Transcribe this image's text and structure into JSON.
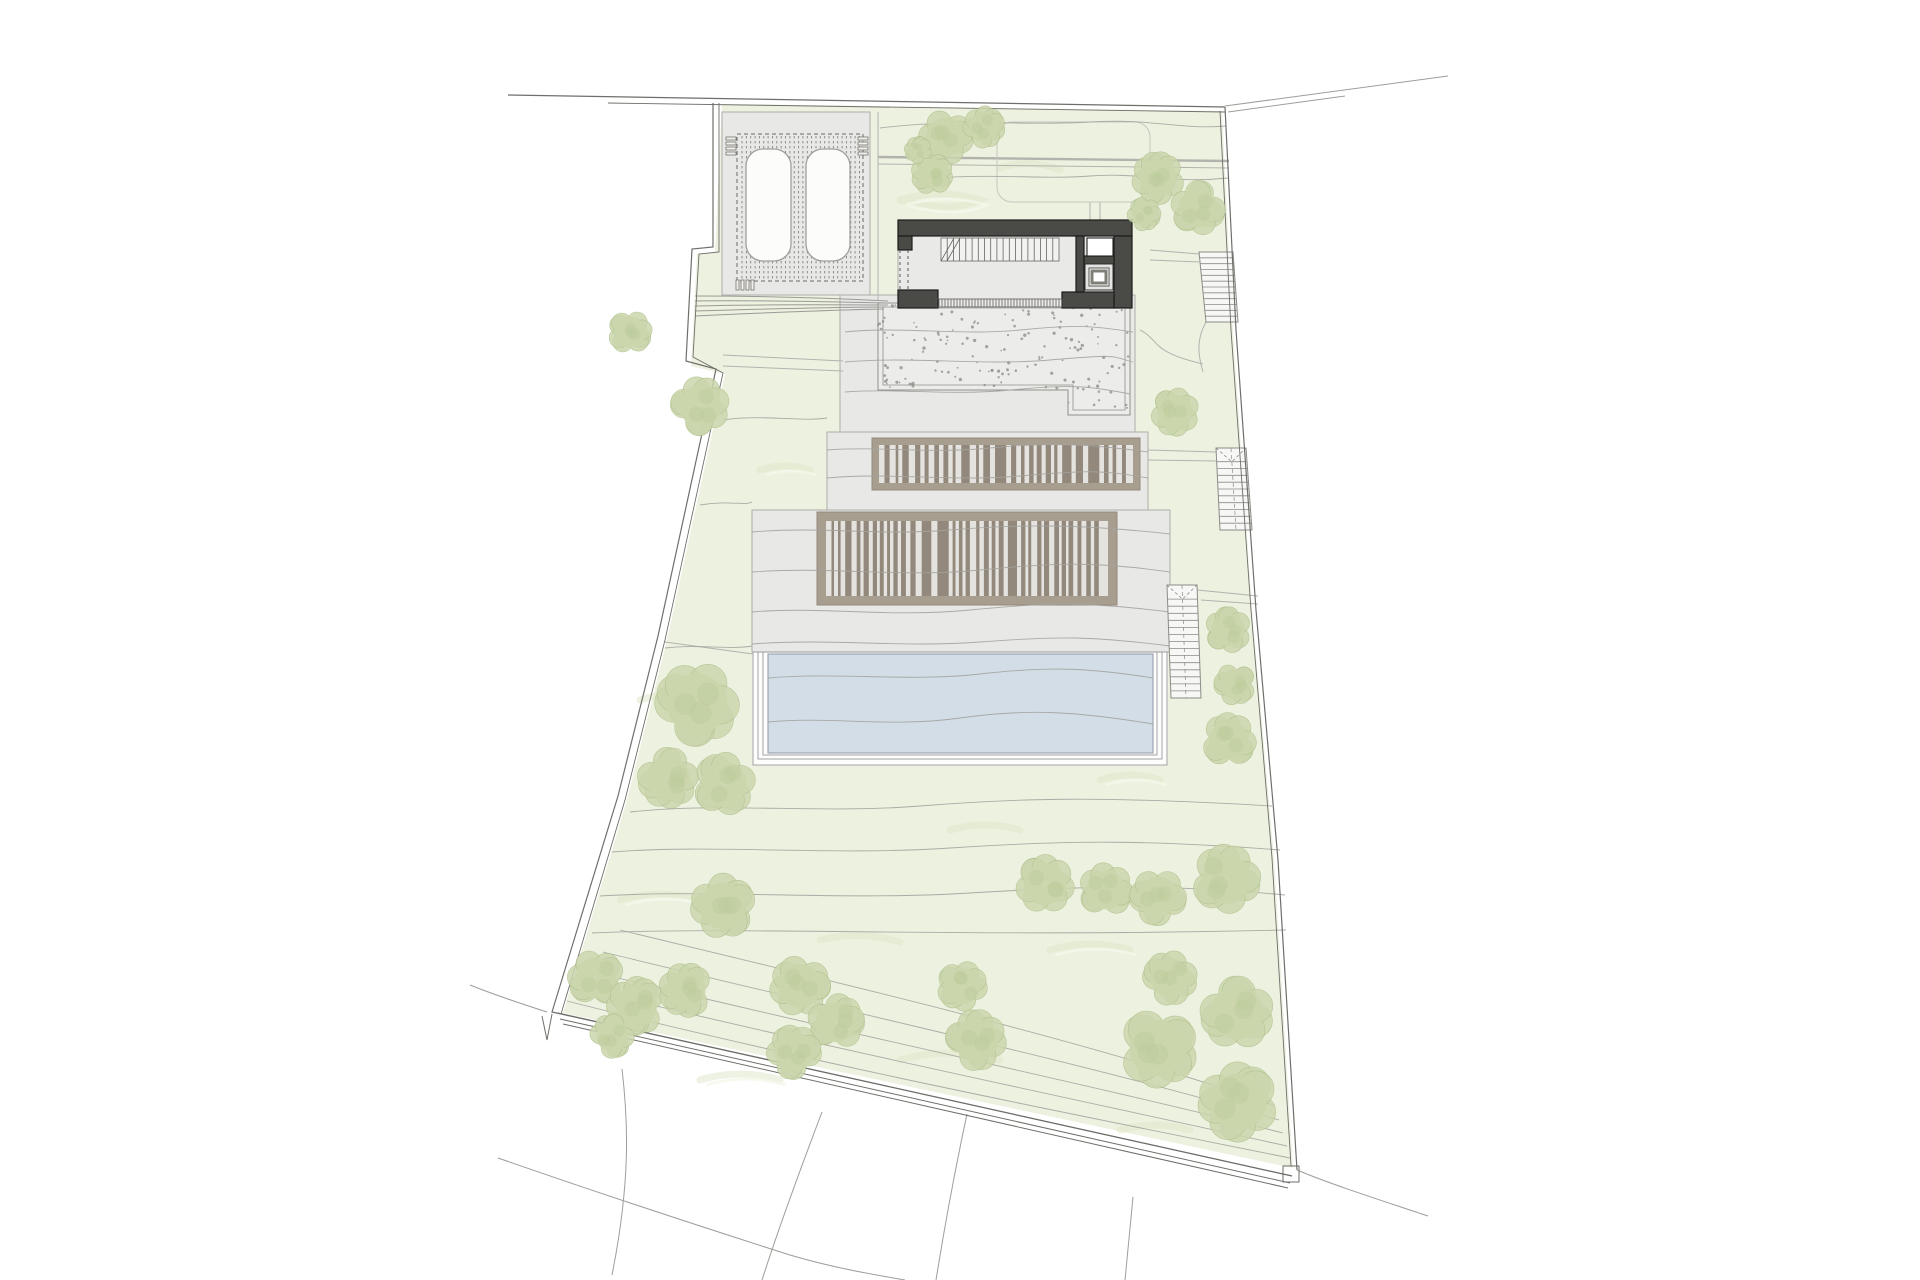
{
  "canvas": {
    "w": 1920,
    "h": 1280,
    "bg": "#ffffff"
  },
  "palette": {
    "green": "#edf1e0",
    "green_texture": "#e0e8cb",
    "green_texture_light": "#f4f7ea",
    "platform_fill": "#e8e8e6",
    "platform_stroke": "#adadaa",
    "stipple_fill": "#ececea",
    "stipple_dot": "#8a8a85",
    "stipple_stroke": "#8f8f8b",
    "frame_fill": "#a89e90",
    "frame_stroke": "#938a7c",
    "deck_inner": "#e5e3df",
    "slat": "#8d8375",
    "wall_dark": "#4a4a47",
    "wall_dark_stroke": "#1c1c1a",
    "floor": "#e9e9e7",
    "pool_water": "#d2dde7",
    "pool_stroke": "#97a1ab",
    "contour": "#a3a39e",
    "boundary": "#6e6e6a",
    "outside_line": "#9d9d99",
    "path_line": "#b3b3ae",
    "stair_fill": "#f7f7f5",
    "stair_stroke": "#8b8b87",
    "tree_fill": "#cbd6ad",
    "tree_inner": "#bccb9b",
    "tree_stroke": "#aebf8a",
    "car_fill": "#fcfcfb",
    "car_stroke": "#a0a09a",
    "dash_line": "#6a6a66",
    "tick": "#55534f"
  },
  "plot": {
    "green_points": "722,104 1222,111 1233,330 1252,610 1274,858 1293,1168 563,1013 627,800 667,640 725,374 691,366 697,254 715,252",
    "boundary_outer": "M713,103 L713,247 L692,249 L686,361 L716,369 L658,636 L618,796 L552,1012 L1292,1176",
    "boundary_inner_left": "M719,103 L719,252 L699,254 L693,357 L723,373 L665,640 L625,800 L561,1014",
    "boundary_top_outer": "M508,95 L1225,107",
    "boundary_top_inner": "M608,103 L1225,112",
    "boundary_right_outer": "M1225,107 L1236,330 L1256,610 L1278,860 L1297,1170",
    "boundary_right_inner": "M1220,111 L1231,330 L1251,610 L1272,858 L1291,1166",
    "boundary_bottom_lines": [
      "M558,1013 L1292,1176",
      "M560,1019 L1290,1183",
      "M563,1024 L1288,1188"
    ],
    "notch_v": "M542,1016 L547,1040 L552,1014",
    "corner_notch": {
      "x": 1283,
      "y": 1166,
      "w": 16,
      "h": 16
    }
  },
  "outside_lines": [
    {
      "d": "M1225,106 L1448,76"
    },
    {
      "d": "M1228,112 L1345,96"
    },
    {
      "d": "M622,1069 C628,1120 631,1180 612,1275"
    },
    {
      "d": "M822,1112 C800,1170 778,1230 762,1280"
    },
    {
      "d": "M967,1114 C955,1170 944,1230 936,1280"
    },
    {
      "d": "M1297,1170 C1330,1184 1380,1200 1428,1216"
    },
    {
      "d": "M1133,1197 C1130,1230 1127,1258 1125,1280"
    },
    {
      "d": "M470,985 C500,997 525,1005 547,1012"
    },
    {
      "d": "M498,1158 C590,1190 680,1220 790,1255 C830,1267 870,1274 905,1280"
    }
  ],
  "texture_squiggles": [
    "M900,200 q40,-12 80,0 q-30,14 -80,0",
    "M1000,168 q30,-10 60,2",
    "M760,470 q25,-8 50,0",
    "M640,700 q30,-10 60,0",
    "M620,900 q40,-12 80,0",
    "M820,940 q40,-10 80,2",
    "M1050,950 q40,-12 80,0",
    "M900,1060 q50,-14 100,0",
    "M1100,780 q30,-10 60,0",
    "M950,830 q35,-10 70,0",
    "M700,1080 q40,-12 80,0",
    "M1120,1130 q35,-10 70,0"
  ],
  "platforms": [
    {
      "name": "carport-platform",
      "x": 722,
      "y": 112,
      "w": 148,
      "h": 183
    },
    {
      "name": "gravel-terrace-platform",
      "x": 840,
      "y": 295,
      "w": 295,
      "h": 137
    },
    {
      "name": "upper-deck-platform",
      "x": 827,
      "y": 432,
      "w": 321,
      "h": 78
    },
    {
      "name": "main-terrace-platform",
      "x": 752,
      "y": 510,
      "w": 418,
      "h": 142
    }
  ],
  "stipple": {
    "outline": "M878,303 L1130,303 L1130,415 L1068,415 L1068,390 L878,390 Z",
    "inner": "M883,307 L1125,307 L1125,410 L1073,410 L1073,385 L883,385 Z",
    "seed": 11,
    "attempts": 170,
    "x": 878,
    "y": 305,
    "w": 252,
    "h": 108,
    "step_x": 1068,
    "y_limit_left": 388,
    "y_limit_right": 413
  },
  "pergola": {
    "rect": {
      "x": 737,
      "y": 134,
      "w": 126,
      "h": 147
    },
    "slat_x0": 742,
    "slat_step": 4.35,
    "slat_x1": 860,
    "slat_y0": 136,
    "slat_y1": 279
  },
  "cars": [
    {
      "x": 746,
      "y": 149,
      "w": 45,
      "h": 112,
      "rx": 17
    },
    {
      "x": 806,
      "y": 149,
      "w": 44,
      "h": 112,
      "rx": 17
    }
  ],
  "combs": [
    {
      "name": "comb-top-left",
      "dir": "h",
      "x": 726,
      "y": 137,
      "n": 4,
      "len": 10,
      "th": 3,
      "gap": 5
    },
    {
      "name": "comb-top-right",
      "dir": "h",
      "x": 858,
      "y": 137,
      "n": 4,
      "len": 10,
      "th": 3,
      "gap": 5
    },
    {
      "name": "comb-bottom-left",
      "dir": "v",
      "x": 736,
      "y": 280,
      "n": 4,
      "len": 10,
      "th": 3,
      "gap": 5
    }
  ],
  "garden_edge_line": "M878,112 L878,300",
  "path_lines": [
    {
      "d": "M723,355 L843,361",
      "w": 1
    },
    {
      "d": "M723,366 L843,371",
      "w": 1
    },
    {
      "d": "M878,157 L1229,161",
      "w": 2.4
    },
    {
      "d": "M878,164 L1229,168",
      "w": 1
    },
    {
      "d": "M1090,202 L1090,250",
      "w": 1
    },
    {
      "d": "M1100,202 L1100,250",
      "w": 1
    },
    {
      "d": "M1150,250 L1199,254",
      "w": 1
    },
    {
      "d": "M1150,260 L1199,262",
      "w": 1
    },
    {
      "d": "M1206,322 C1196,340 1198,355 1203,372",
      "w": 1
    },
    {
      "d": "M1140,330 C1160,340 1150,352 1203,364",
      "w": 1
    },
    {
      "d": "M1148,450 L1216,452",
      "w": 1
    },
    {
      "d": "M1148,460 L1216,461",
      "w": 1
    },
    {
      "d": "M1197,590 L1258,596",
      "w": 1
    },
    {
      "d": "M1201,600 L1258,604",
      "w": 1
    },
    {
      "d": "M665,642 L753,654",
      "w": 1
    }
  ],
  "path_loop": {
    "x": 997,
    "y": 122,
    "w": 153,
    "h": 80,
    "rx": 15
  },
  "driveway_lines": [
    "M695,296 C760,296 830,298 888,301",
    "M695,301 C765,300 835,302 888,303",
    "M695,306 C770,304 840,305 888,305",
    "M695,311 C765,309 835,307 886,307",
    "M695,316 C760,313 830,310 884,309"
  ],
  "pool": {
    "deck_rects": [
      {
        "x": 753,
        "y": 652,
        "w": 414,
        "h": 113
      },
      {
        "x": 758,
        "y": 652,
        "w": 404,
        "h": 107
      },
      {
        "x": 763,
        "y": 652,
        "w": 394,
        "h": 103
      }
    ],
    "water": {
      "x": 768,
      "y": 654,
      "w": 385,
      "h": 99
    }
  },
  "louver_decks": [
    {
      "name": "upper-louver-roof",
      "frame": {
        "x": 872,
        "y": 438,
        "w": 268,
        "h": 52
      },
      "inner": {
        "x": 879,
        "y": 445,
        "w": 254,
        "h": 38
      },
      "seed": 7
    },
    {
      "name": "lower-louver-roof",
      "frame": {
        "x": 817,
        "y": 512,
        "w": 300,
        "h": 93
      },
      "inner": {
        "x": 826,
        "y": 521,
        "w": 282,
        "h": 75
      },
      "seed": 19
    }
  ],
  "structure": {
    "floor": {
      "x": 898,
      "y": 220,
      "w": 234,
      "h": 88
    },
    "walls": [
      {
        "x": 898,
        "y": 220,
        "w": 234,
        "h": 16
      },
      {
        "x": 1114,
        "y": 236,
        "w": 18,
        "h": 72
      },
      {
        "x": 1062,
        "y": 292,
        "w": 52,
        "h": 16
      },
      {
        "x": 898,
        "y": 290,
        "w": 40,
        "h": 18
      },
      {
        "x": 898,
        "y": 236,
        "w": 14,
        "h": 14
      },
      {
        "x": 1076,
        "y": 236,
        "w": 8,
        "h": 56
      },
      {
        "x": 1084,
        "y": 256,
        "w": 30,
        "h": 8
      }
    ],
    "dashed_lines": [
      "M900,250 L900,290",
      "M908,250 L908,290"
    ],
    "white_room": {
      "x": 1087,
      "y": 238,
      "w": 26,
      "h": 18
    },
    "skylight": {
      "outer": {
        "x": 1085,
        "y": 264,
        "w": 28,
        "h": 26
      },
      "mid": {
        "x": 1089,
        "y": 268,
        "w": 20,
        "h": 18
      },
      "inner": {
        "x": 1092,
        "y": 271,
        "w": 14,
        "h": 12
      }
    },
    "stair": {
      "x0": 941,
      "x1": 1059,
      "y0": 238,
      "y1": 261,
      "n": 19,
      "breaks": [
        "M941,261 L954,238",
        "M947,261 L960,238"
      ]
    },
    "ticks": {
      "x0": 936,
      "x1": 1062,
      "y0": 299,
      "y1": 307,
      "step": 3
    }
  },
  "stairs": [
    {
      "name": "garden-stair-top",
      "pts": [
        [
          1199,
          252
        ],
        [
          1233,
          252
        ],
        [
          1238,
          322
        ],
        [
          1206,
          322
        ]
      ],
      "treads": 12,
      "tri": false,
      "center_dash": false
    },
    {
      "name": "garden-stair-middle",
      "pts": [
        [
          1216,
          448
        ],
        [
          1246,
          448
        ],
        [
          1252,
          530
        ],
        [
          1220,
          530
        ]
      ],
      "treads": 12,
      "tri": true,
      "center_dash": true
    },
    {
      "name": "garden-stair-pool",
      "pts": [
        [
          1167,
          585
        ],
        [
          1197,
          585
        ],
        [
          1201,
          698
        ],
        [
          1171,
          698
        ]
      ],
      "treads": 16,
      "tri": true,
      "center_dash": true
    }
  ],
  "contours": [
    "M880,128 C960,118 1030,126 1090,122 S1180,130 1226,126",
    "M920,180 C980,172 1040,180 1090,176 S1170,184 1228,178",
    "M845,332 C900,326 960,336 1020,330 S1090,326 1133,332",
    "M845,362 C910,356 980,366 1050,360 S1110,356 1133,362",
    "M845,392 C900,388 950,396 1010,390 S1090,386 1130,394",
    "M827,450 C880,446 930,454 990,448 S1090,444 1148,452",
    "M827,478 C890,472 950,482 1020,476 S1100,470 1148,478",
    "M752,532 C820,526 880,536 950,530 S1080,524 1170,534",
    "M752,572 C830,566 900,578 980,570 S1100,562 1170,572",
    "M752,612 C820,606 890,618 970,610 S1090,602 1170,612",
    "M752,644 C830,638 900,648 980,642 S1090,636 1170,646",
    "M768,678 C840,672 910,682 980,674 S1090,668 1153,678",
    "M768,722 C830,716 890,728 960,718 S1080,712 1153,724",
    "M665,648 C700,644 730,650 752,646",
    "M723,420 C760,414 800,422 827,418",
    "M700,505 C730,500 745,506 752,502",
    "M630,812 C720,802 820,814 920,806 S1100,796 1272,806",
    "M612,852 C710,844 830,856 950,848 S1150,840 1280,850",
    "M600,896 C710,889 840,901 970,893 S1180,885 1285,895",
    "M592,933 C750,926 950,938 1286,930",
    "M567,1001 C800,1060 1050,1110 1290,1158",
    "M577,987 C820,1046 1060,1096 1287,1146",
    "M589,971 C830,1030 1080,1082 1283,1133",
    "M603,952 C840,1010 1090,1064 1279,1120",
    "M620,930 C860,988 1100,1044 1275,1106"
  ],
  "trees": [
    {
      "cx": 946,
      "cy": 137,
      "r": 26
    },
    {
      "cx": 984,
      "cy": 127,
      "r": 20
    },
    {
      "cx": 932,
      "cy": 174,
      "r": 20
    },
    {
      "cx": 918,
      "cy": 150,
      "r": 13
    },
    {
      "cx": 1158,
      "cy": 178,
      "r": 25
    },
    {
      "cx": 1198,
      "cy": 208,
      "r": 26
    },
    {
      "cx": 1144,
      "cy": 214,
      "r": 16
    },
    {
      "cx": 630,
      "cy": 332,
      "r": 21
    },
    {
      "cx": 700,
      "cy": 406,
      "r": 28
    },
    {
      "cx": 1175,
      "cy": 412,
      "r": 23
    },
    {
      "cx": 1228,
      "cy": 630,
      "r": 22
    },
    {
      "cx": 1235,
      "cy": 684,
      "r": 20
    },
    {
      "cx": 1229,
      "cy": 740,
      "r": 26
    },
    {
      "cx": 697,
      "cy": 704,
      "r": 40
    },
    {
      "cx": 668,
      "cy": 778,
      "r": 29
    },
    {
      "cx": 724,
      "cy": 784,
      "r": 30
    },
    {
      "cx": 723,
      "cy": 906,
      "r": 31
    },
    {
      "cx": 596,
      "cy": 978,
      "r": 27
    },
    {
      "cx": 636,
      "cy": 1006,
      "r": 28
    },
    {
      "cx": 686,
      "cy": 990,
      "r": 26
    },
    {
      "cx": 612,
      "cy": 1036,
      "r": 21
    },
    {
      "cx": 800,
      "cy": 986,
      "r": 29
    },
    {
      "cx": 836,
      "cy": 1022,
      "r": 27
    },
    {
      "cx": 794,
      "cy": 1052,
      "r": 26
    },
    {
      "cx": 962,
      "cy": 986,
      "r": 24
    },
    {
      "cx": 976,
      "cy": 1040,
      "r": 29
    },
    {
      "cx": 1045,
      "cy": 884,
      "r": 28
    },
    {
      "cx": 1106,
      "cy": 890,
      "r": 26
    },
    {
      "cx": 1158,
      "cy": 897,
      "r": 27
    },
    {
      "cx": 1226,
      "cy": 879,
      "r": 33
    },
    {
      "cx": 1170,
      "cy": 978,
      "r": 26
    },
    {
      "cx": 1237,
      "cy": 1013,
      "r": 35
    },
    {
      "cx": 1158,
      "cy": 1048,
      "r": 38
    },
    {
      "cx": 1238,
      "cy": 1102,
      "r": 38
    }
  ]
}
